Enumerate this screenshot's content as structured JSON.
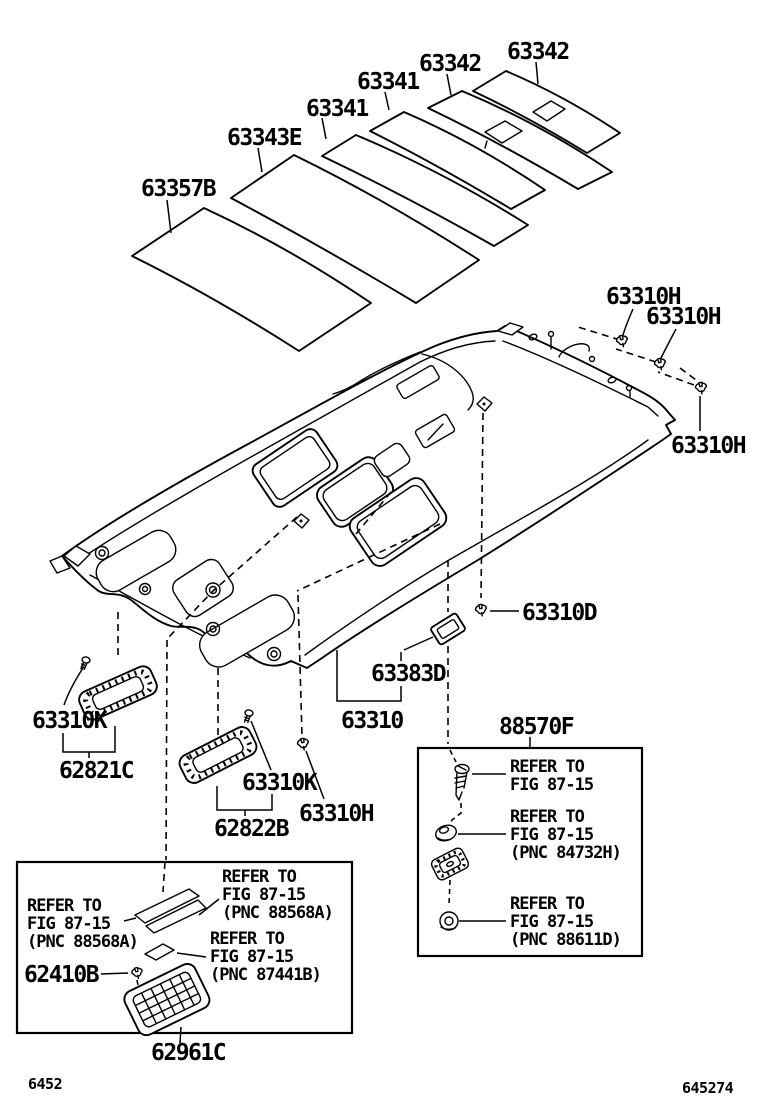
{
  "labels": {
    "pad_63357b": "63357B",
    "pad_63343e": "63343E",
    "pad_63341_1": "63341",
    "pad_63341_2": "63341",
    "pad_63342_1": "63342",
    "pad_63342_2": "63342",
    "clip_63310h_1": "63310H",
    "clip_63310h_2": "63310H",
    "clip_63310h_3": "63310H",
    "clip_63310h_4": "63310H",
    "clip_63310d": "63310D",
    "bracket_63383d": "63383D",
    "headlining_63310": "63310",
    "hardware_88570f": "88570F",
    "screw_63310k_1": "63310K",
    "screw_63310k_2": "63310K",
    "visor_62821c": "62821C",
    "visor_62822b": "62822B",
    "clip_62410b": "62410B",
    "maplamp_62961c": "62961C"
  },
  "notes": {
    "left": [
      {
        "l1": "REFER TO",
        "l2": "FIG 87-15",
        "l3": "(PNC 88568A)"
      },
      {
        "l1": "REFER TO",
        "l2": "FIG 87-15",
        "l3": "(PNC 88568A)"
      },
      {
        "l1": "REFER TO",
        "l2": "FIG 87-15",
        "l3": "(PNC 87441B)"
      }
    ],
    "right": [
      {
        "l1": "REFER TO",
        "l2": "FIG 87-15"
      },
      {
        "l1": "REFER TO",
        "l2": "FIG 87-15",
        "l3": "(PNC 84732H)"
      },
      {
        "l1": "REFER TO",
        "l2": "FIG 87-15",
        "l3": "(PNC 88611D)"
      }
    ]
  },
  "footer": {
    "page_code": "6452",
    "figure_code": "645274"
  }
}
